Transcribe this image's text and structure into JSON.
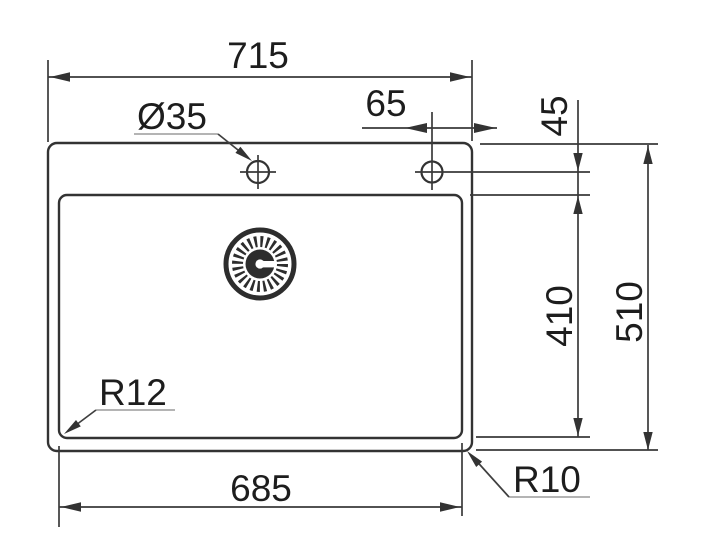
{
  "drawing": {
    "labels": {
      "overall_width": "715",
      "hole_diameter": "Ø35",
      "hole_offset_right": "65",
      "hole_inset_top": "45",
      "bowl_depth": "410",
      "overall_depth": "510",
      "bowl_width": "685",
      "bowl_corner_radius": "R12",
      "outer_corner_radius": "R10"
    },
    "colors": {
      "line": "#3a3a3a",
      "text": "#1d1d1d",
      "leader_underline": "#9b9b9b",
      "background": "#ffffff"
    }
  }
}
